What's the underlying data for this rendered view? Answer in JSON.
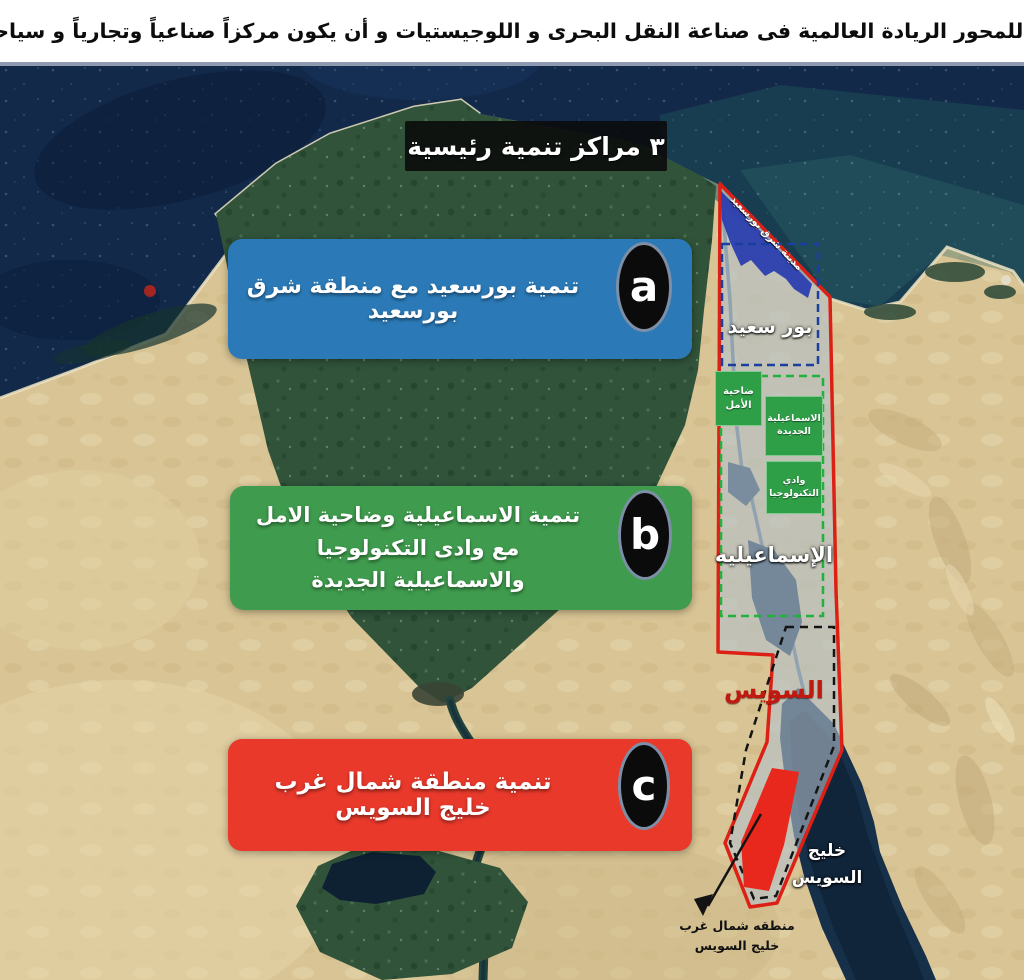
{
  "header": {
    "title": "أن يكون للمحور الريادة العالمية فى صناعة النقل البحرى و اللوجيستيات و أن يكون مركزاً صناعياً وتجارياً و سياحياً عالمياً"
  },
  "map": {
    "main_banner_label": "٣ مراكز تنمية رئيسية",
    "development_zones": [
      {
        "id": "a",
        "label": "تنمية بورسعيد مع منطقة شرق بورسعيد",
        "color": "#2b7ab7"
      },
      {
        "id": "b",
        "label": "تنمية الاسماعيلية وضاحية الامل مع وادى التكنولوجيا والاسماعيلية الجديدة",
        "color": "#3f9b4d"
      },
      {
        "id": "c",
        "label": "تنمية منطقة شمال غرب خليج السويس",
        "color": "#e8392b"
      }
    ],
    "region_labels": {
      "east_port_said_city": "مدينة شرق بورسعيد",
      "port_said": "بور سعيد",
      "amal_suburb": "ضاحية الأمل",
      "new_ismailia": "الاسماعيلية الجديدة",
      "technology_valley": "وادي التكنولوجيا",
      "ismailia": "الإسماعيليه",
      "suez": "السويس",
      "gulf_of_suez": "خليج السويس",
      "nw_gulf_zone_note": "منطقه شمال غرب خليج السويس"
    },
    "colors": {
      "zone_border": "#dd2015",
      "zone_overlay_fill": "#b2c0cc",
      "east_port_said_fill": "#2b3eae",
      "nw_gulf_zone_fill": "#e8281c",
      "port_said_dash": "#1a3f9e",
      "ismailia_dash": "#21b13c",
      "suez_dash": "#141414"
    }
  }
}
